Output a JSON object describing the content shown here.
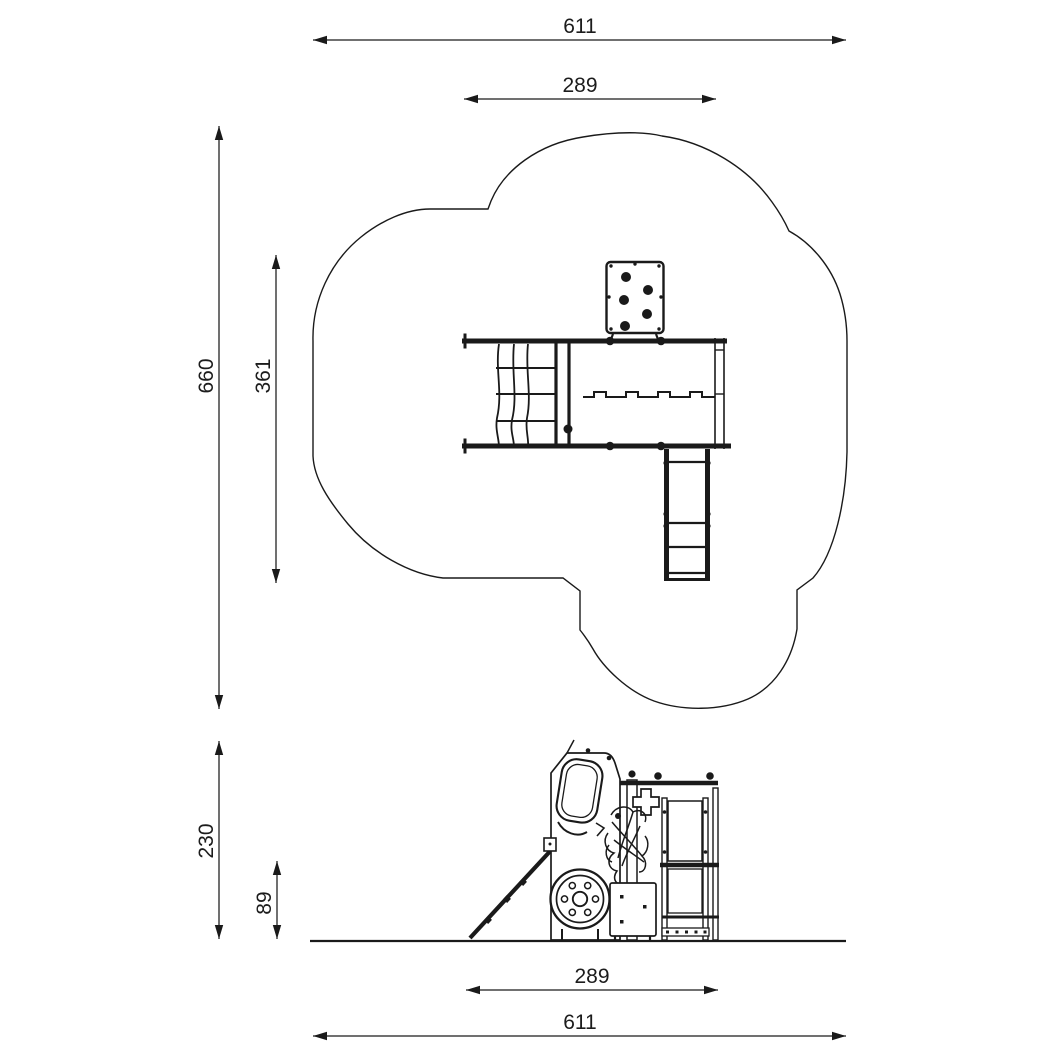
{
  "colors": {
    "line": "#1a1a1a",
    "background": "#ffffff"
  },
  "dims": {
    "plan_overall_width": "611",
    "plan_structure_width": "289",
    "plan_overall_depth": "660",
    "plan_inner_depth": "361",
    "side_overall_height": "230",
    "side_platform_height": "89",
    "side_structure_width": "289",
    "side_overall_width": "611"
  }
}
